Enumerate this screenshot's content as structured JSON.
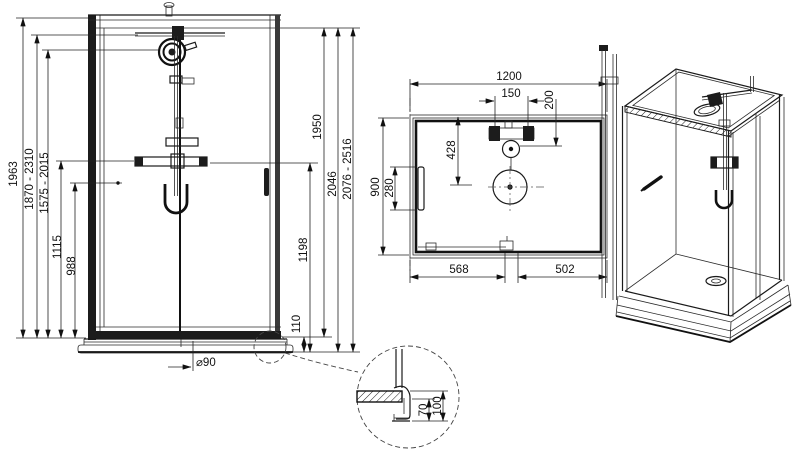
{
  "drawing": {
    "front_view": {
      "left_dims": [
        "1963",
        "1870 - 2310",
        "1575 - 2015",
        "1115",
        "988"
      ],
      "right_dims": [
        "1950",
        "2046",
        "2076 - 2516",
        "1198",
        "110"
      ],
      "drain_dim": "⌀90"
    },
    "top_view": {
      "width_dim": "1200",
      "valve_spacing_dim": "150",
      "valve_offset_dim": "200",
      "rose_offset_dim": "428",
      "depth_dim": "900",
      "handle_dim": "280",
      "door_left_dim": "568",
      "door_right_dim": "502"
    },
    "detail_view": {
      "profile_dim": "70",
      "total_dim": "100"
    }
  }
}
